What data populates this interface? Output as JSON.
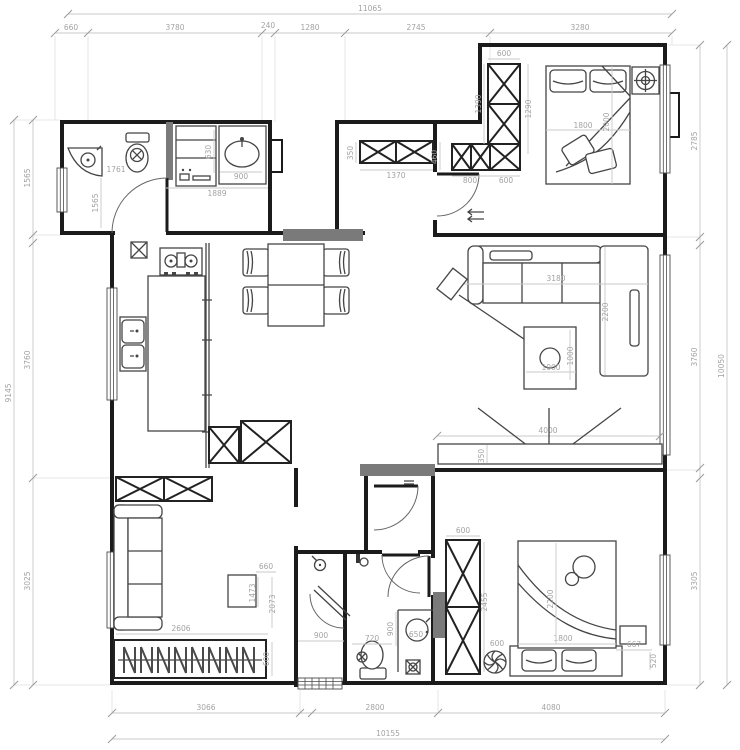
{
  "drawing_title": "apartment-floor-plan",
  "colors": {
    "wall": "#1b1b1b",
    "dimension": "#a3a3a3",
    "gray_wall": "#7a7a7a",
    "background": "#ffffff"
  },
  "dims": {
    "top": {
      "overall": "11065",
      "segments": [
        "660",
        "3780",
        "240",
        "1280",
        "2745",
        "3280"
      ]
    },
    "bottom": {
      "overall": "10155",
      "segments": [
        "3066",
        "2800",
        "4080"
      ]
    },
    "left": {
      "overall": "9145",
      "segments": [
        "1565",
        "3760",
        "3025"
      ]
    },
    "right": {
      "overall": "10050",
      "segments": [
        "2785",
        "3760",
        "3305"
      ]
    }
  },
  "rooms": {
    "bath_top": {
      "width": "1761",
      "depth": "1565"
    },
    "laundry": {
      "counter_depth": "630",
      "basin_width": "900",
      "total_width": "1889"
    },
    "entry": {
      "shoe_cabinet_depth": "350",
      "shoe_cabinet_width": "1370",
      "cabinet_depth": "460",
      "cabinet_width": "800",
      "wardrobe_bottom": "600"
    },
    "bedroom_top": {
      "wardrobe_width": "600",
      "wardrobe_height": "1390",
      "clearance": "1290",
      "bed_width": "1800",
      "bed_length": "2000"
    },
    "living": {
      "sofa_width": "3180",
      "sofa_depth": "2200",
      "table_width": "1000",
      "table_depth": "1000",
      "tv_wall": "4000",
      "tv_depth": "350"
    },
    "bedroom_left": {
      "sofa_width": "2606",
      "wardrobe_depth": "600",
      "desk_width": "660",
      "dim_a": "1473",
      "dim_b": "2073"
    },
    "bath_bottom": {
      "shower_width": "900",
      "toilet_width": "720",
      "basin_width": "650",
      "basin_depth": "900"
    },
    "bedroom_right": {
      "wardrobe_width": "600",
      "wardrobe_height": "2455",
      "gap": "600",
      "bed_width": "1800",
      "bed_length": "2200",
      "nightstand": "667",
      "side": "520"
    }
  }
}
